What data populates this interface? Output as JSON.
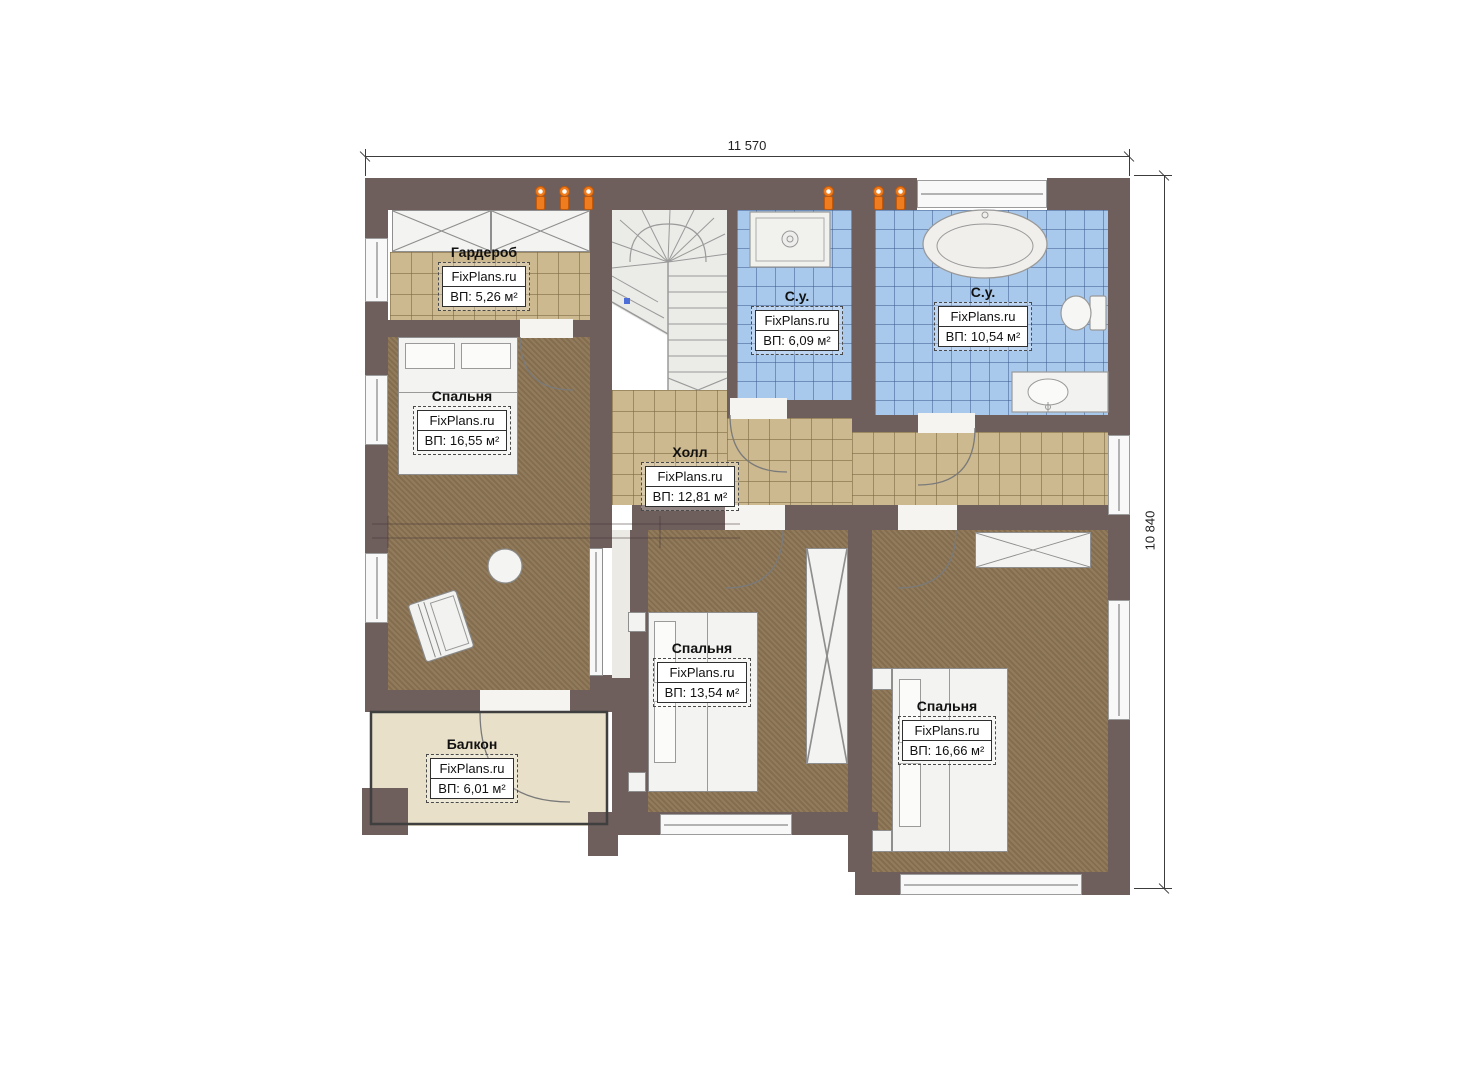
{
  "dims": {
    "width": "11 570",
    "height": "10 840"
  },
  "rooms": [
    {
      "id": "wardrobe",
      "name": "Гардероб",
      "brand": "FixPlans.ru",
      "area": "ВП: 5,26 м²"
    },
    {
      "id": "bedroom-left",
      "name": "Спальня",
      "brand": "FixPlans.ru",
      "area": "ВП: 16,55 м²"
    },
    {
      "id": "bathroom-small",
      "name": "С.у.",
      "brand": "FixPlans.ru",
      "area": "ВП: 6,09 м²"
    },
    {
      "id": "bathroom-large",
      "name": "С.у.",
      "brand": "FixPlans.ru",
      "area": "ВП: 10,54 м²"
    },
    {
      "id": "hall",
      "name": "Холл",
      "brand": "FixPlans.ru",
      "area": "ВП: 12,81 м²"
    },
    {
      "id": "bedroom-middle",
      "name": "Спальня",
      "brand": "FixPlans.ru",
      "area": "ВП: 13,54 м²"
    },
    {
      "id": "bedroom-right",
      "name": "Спальня",
      "brand": "FixPlans.ru",
      "area": "ВП: 16,66 м²"
    },
    {
      "id": "balcony",
      "name": "Балкон",
      "brand": "FixPlans.ru",
      "area": "ВП: 6,01 м²"
    }
  ],
  "colors": {
    "wall": "#6e5e5c",
    "tile_tan": "#cdb98f",
    "tile_blue": "#a9c9ec",
    "floor_brown": "#8b7453",
    "balcony_floor": "#e9e0ca",
    "radiator_accent": "#ef7d1f"
  }
}
